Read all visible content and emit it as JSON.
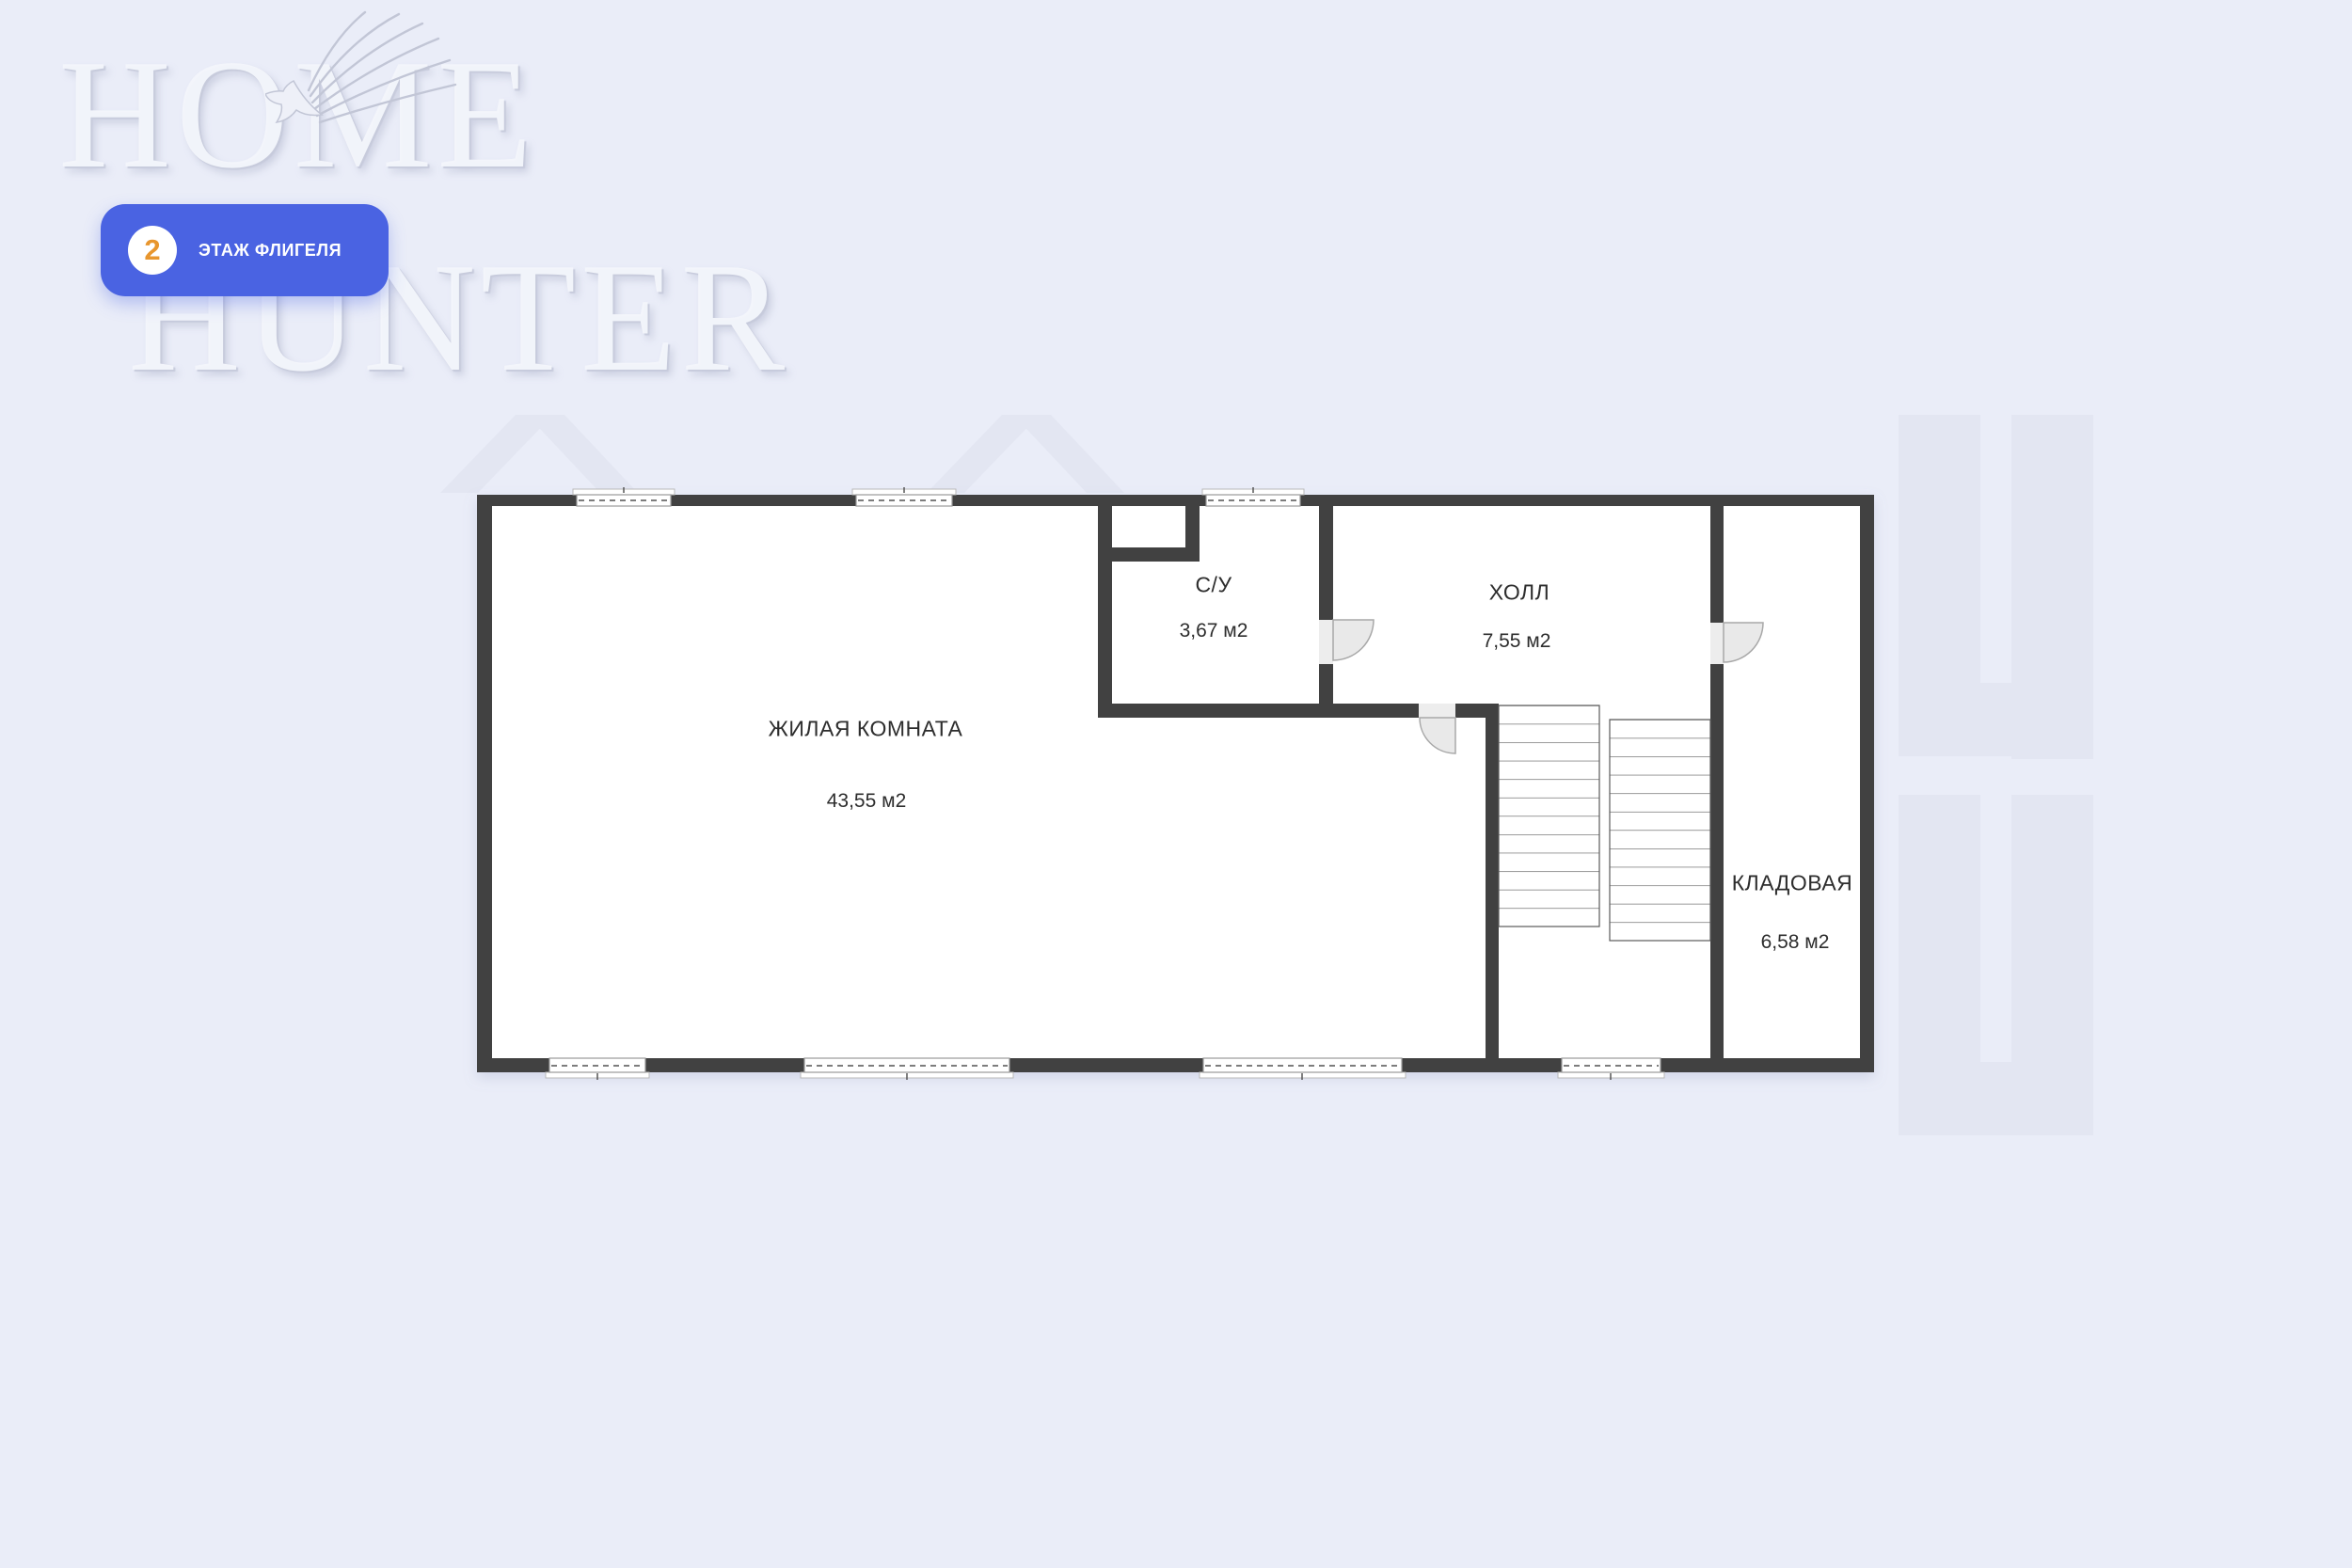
{
  "watermark": {
    "line1": "HOME",
    "line2": "HUNTER"
  },
  "badge": {
    "number": "2",
    "label": "ЭТАЖ ФЛИГЕЛЯ"
  },
  "rooms": [
    {
      "name": "ЖИЛАЯ КОМНАТА",
      "area": "43,55 м2"
    },
    {
      "name": "С/У",
      "area": "3,67 м2"
    },
    {
      "name": "ХОЛЛ",
      "area": "7,55 м2"
    },
    {
      "name": "КЛАДОВАЯ",
      "area": "6,58 м2"
    }
  ],
  "colors": {
    "background": "#eaedf8",
    "wall": "#414141",
    "room_fill": "#ffffff",
    "badge_blue": "#4a63e2",
    "badge_number_orange": "#e8962e",
    "door_fill": "#e9e9e9",
    "watermark_tint": "#e3e6f2"
  }
}
